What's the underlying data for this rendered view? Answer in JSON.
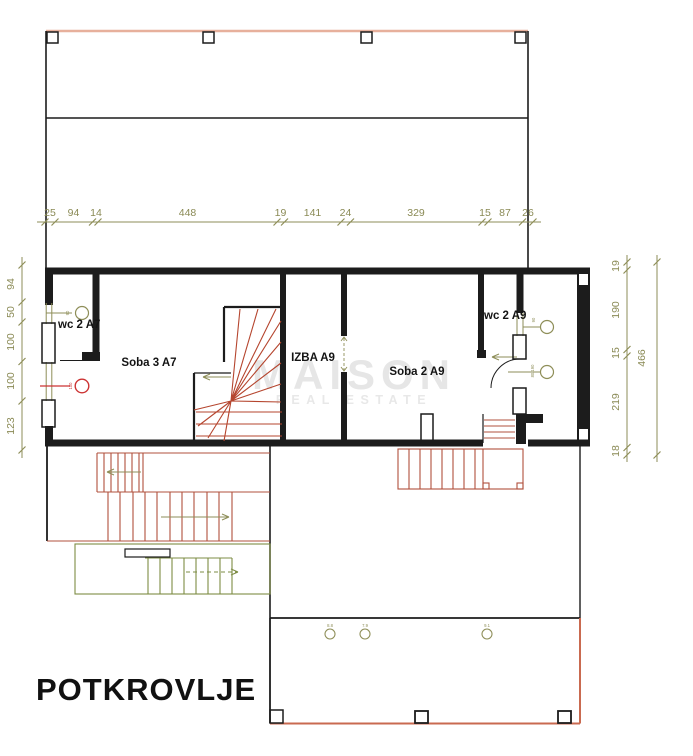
{
  "title": "POTKROVLJE",
  "watermark": {
    "line1": "MAISON",
    "line2": "REAL ESTATE"
  },
  "rooms": {
    "soba3": "Soba 3 A7",
    "izba": "IZBA A9",
    "soba2": "Soba 2 A9",
    "wc_left": "wc 2 A7",
    "wc_right": "wc 2 A9"
  },
  "dimensions": {
    "top": [
      "25",
      "94",
      "14",
      "448",
      "19",
      "141",
      "24",
      "329",
      "15",
      "87",
      "26"
    ],
    "left": [
      "94",
      "50",
      "100",
      "100",
      "123"
    ],
    "right_inner": [
      "19",
      "190",
      "15",
      "219",
      "18"
    ],
    "right_outer": "466"
  },
  "fixture_labels": {
    "wc_left_top": "90",
    "wc_left_bottom": "100",
    "wc_right_top": "90",
    "wc_right_bottom": "80/190",
    "terrace": [
      "8.8",
      "7.9",
      "9.1"
    ]
  },
  "colors": {
    "walls": "#1c1c1c",
    "dimensions": "#8e8e58",
    "stair_red": "#b0503c",
    "stair_green": "#7d8c44",
    "roof_pink": "#e7b09c",
    "terrace_red": "#c96a50",
    "fixture_red": "#cc3333",
    "watermark": "#e6e6e6"
  }
}
